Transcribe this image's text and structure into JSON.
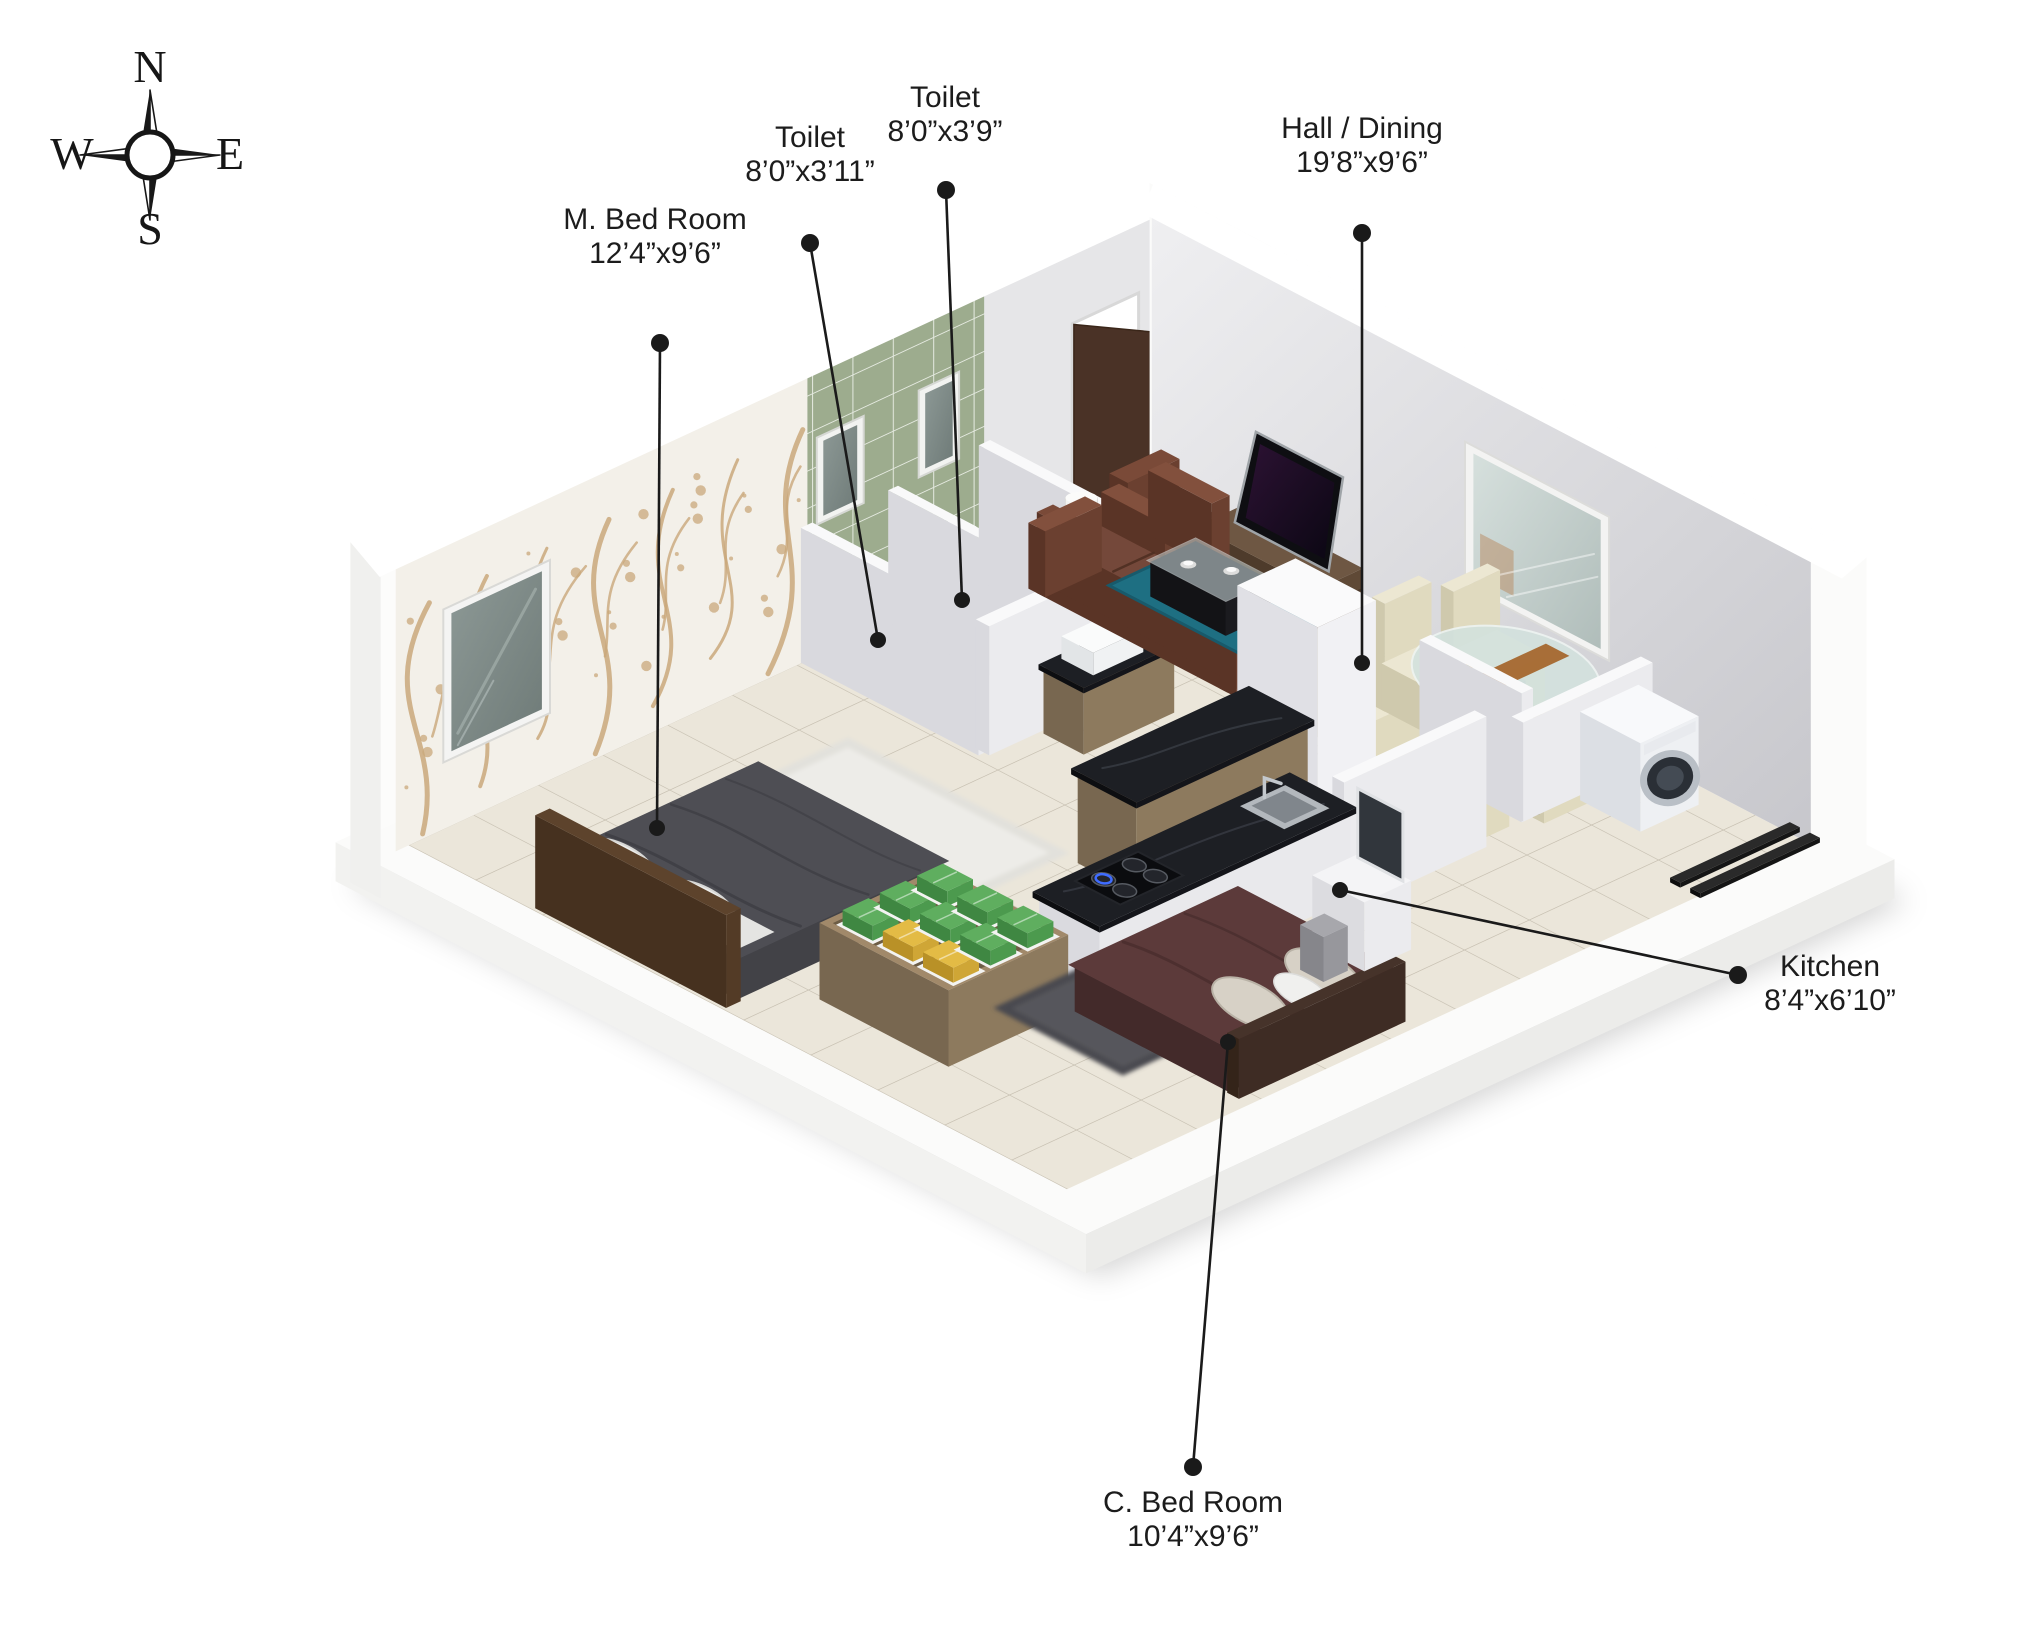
{
  "compass": {
    "north": "N",
    "south": "S",
    "east": "E",
    "west": "W"
  },
  "labels": {
    "m_bedroom": {
      "name": "M. Bed Room",
      "dims": "12’4”x9’6”"
    },
    "toilet_1": {
      "name": "Toilet",
      "dims": "8’0”x3’11”"
    },
    "toilet_2": {
      "name": "Toilet",
      "dims": "8’0”x3’9”"
    },
    "hall_dining": {
      "name": "Hall / Dining",
      "dims": "19’8”x9’6”"
    },
    "kitchen": {
      "name": "Kitchen",
      "dims": "8’4”x6’10”"
    },
    "c_bedroom": {
      "name": "C. Bed Room",
      "dims": "10’4”x9’6”"
    }
  },
  "palette": {
    "leader_line": "#1a1a1a",
    "label_text": "#1c1c1c",
    "floor_beige": "#ebe6da",
    "tile_green_wall": "#9dac8e",
    "tile_green_floor": "#a8b49b",
    "wallpaper_branch": "#c9a87b",
    "sofa_brown": "#6b4030",
    "bed_gray": "#4e4e54",
    "bed_maroon": "#5c3a3a",
    "rug_teal": "#1e6f82",
    "towel_green": "#5fae5f",
    "towel_yellow": "#e3bb45",
    "wood": "#8d7a5e",
    "counter_black": "#14151a"
  }
}
